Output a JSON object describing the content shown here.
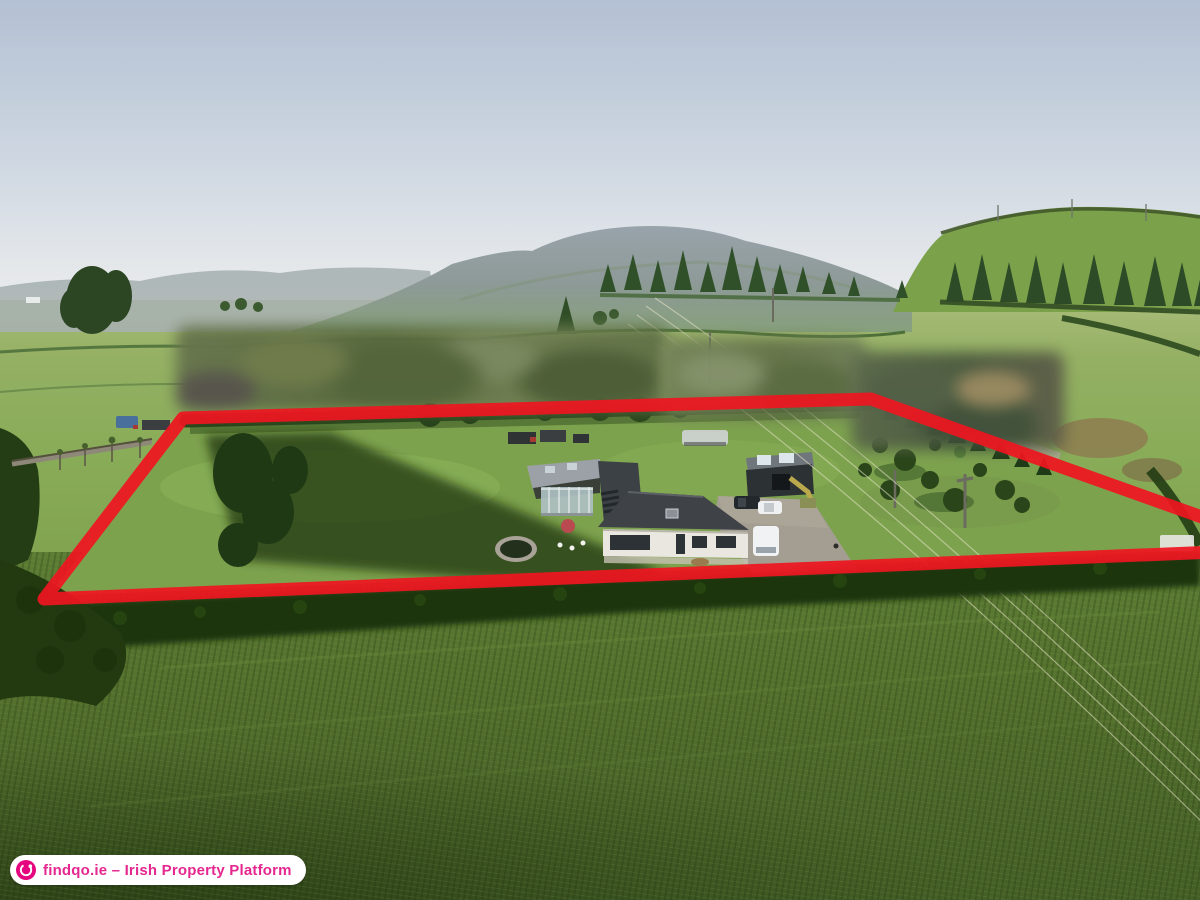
{
  "watermark": {
    "icon": "globe-icon",
    "label": "findqo.ie – Irish Property Platform",
    "text_color": "#e5278f",
    "icon_color": "#e5067f",
    "pill_color": "#ffffff"
  },
  "overlay": {
    "type": "property-boundary",
    "color": "#ee1520",
    "stroke_width": "13",
    "points": "44,599 183,418 871,399 1213,521 1217,552"
  },
  "scene": {
    "description": "Aerial drone photograph of a white bungalow with grey-roofed outbuildings, glass conservatory, parked cars and long lawned site in rural Ireland; site outlined in red, neighbouring houses blurred, mountain on the horizon",
    "palette": {
      "sky": "#c2cddb",
      "mountain": "#8e9aa4",
      "fields": "#85a854",
      "foreground_field": "#53702d",
      "hedgerow": "#25400f",
      "house_roof": "#3f4347",
      "house_walls": "#e9e7df",
      "driveway": "#a39e91"
    }
  }
}
